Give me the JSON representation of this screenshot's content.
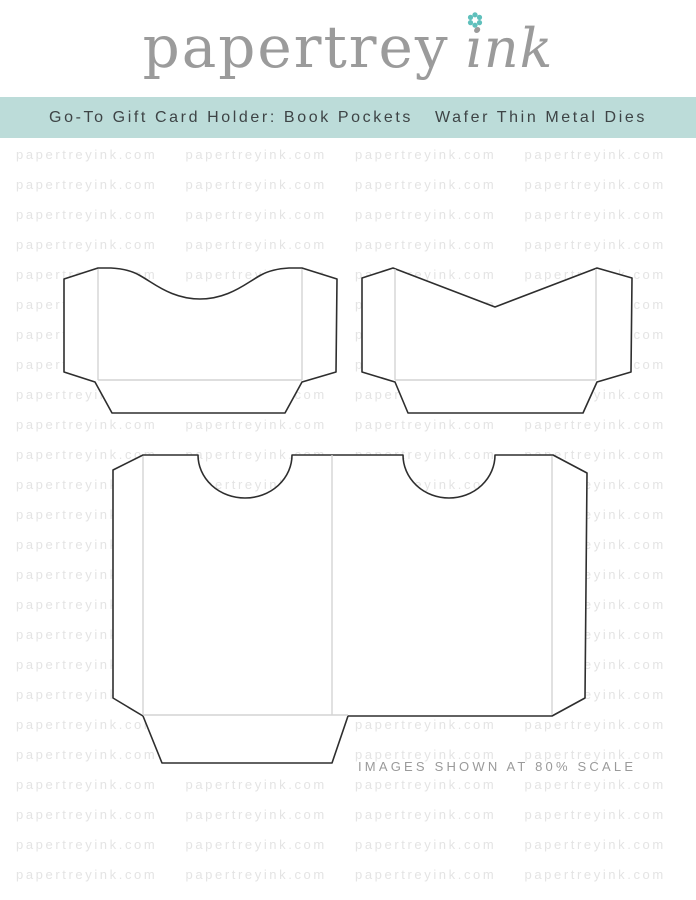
{
  "header": {
    "logo_text": "papertrey",
    "logo_script": "ink",
    "logo_color": "#9b9b9b",
    "flower_color": "#5fc0bc"
  },
  "banner": {
    "title_left": "Go-To Gift Card Holder: Book Pockets",
    "title_right": "Wafer Thin Metal Dies",
    "bg_color": "#bcdcd9",
    "text_color": "#3e4446"
  },
  "watermark": {
    "text": "papertreyink.com",
    "rows": 25,
    "cols": 4,
    "color": "#e4e4e4"
  },
  "diagram": {
    "shapes": [
      "book-pocket-curved-notch",
      "book-pocket-v-notch",
      "gift-card-holder-double-pocket"
    ],
    "outline_color": "#2e2e2e",
    "fold_line_color": "#d4d4d4"
  },
  "footer_note": "IMAGES SHOWN AT 80% SCALE"
}
